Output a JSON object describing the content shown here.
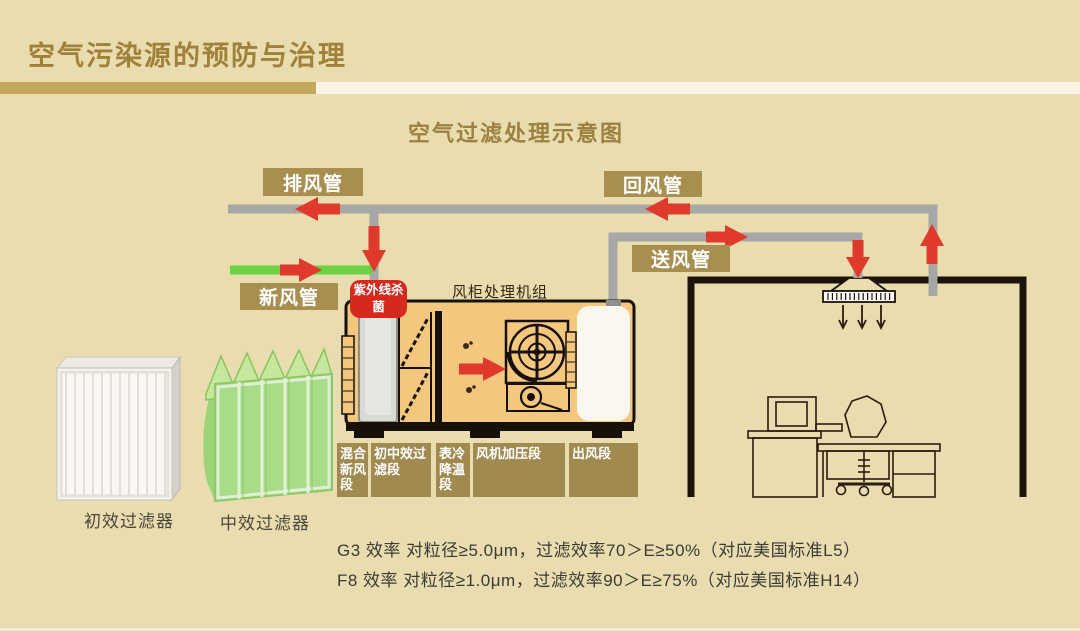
{
  "slide": {
    "title": "空气污染源的预防与治理",
    "diagram_title": "空气过滤处理示意图"
  },
  "ducts": {
    "exhaust": "排风管",
    "return": "回风管",
    "fresh": "新风管",
    "supply": "送风管"
  },
  "ahu": {
    "label": "风柜处理机组",
    "uv_badge": "紫外线杀菌",
    "sections": [
      "混合新风段",
      "初中效过滤段",
      "表冷降温段",
      "风机加压段",
      "出风段"
    ]
  },
  "filters": {
    "primary": "初效过滤器",
    "medium": "中效过滤器"
  },
  "specs": [
    "G3 效率 对粒径≥5.0μm，过滤效率70＞E≥50%（对应美国标准L5）",
    "F8 效率 对粒径≥1.0μm，过滤效率90＞E≥75%（对应美国标准H14）"
  ],
  "colors": {
    "background": "#e9dcae",
    "title_gold": "#a0813a",
    "label_gold": "#a88e4f",
    "divider_gold": "#c4a85e",
    "divider_cream": "#fcf4e2",
    "duct_gray": "#a7a7a7",
    "fresh_green": "#6bd341",
    "arrow_red": "#e03a2d",
    "badge_red": "#d7281d",
    "ahu_fill": "#f3c77e",
    "wall_black": "#1c130a"
  }
}
